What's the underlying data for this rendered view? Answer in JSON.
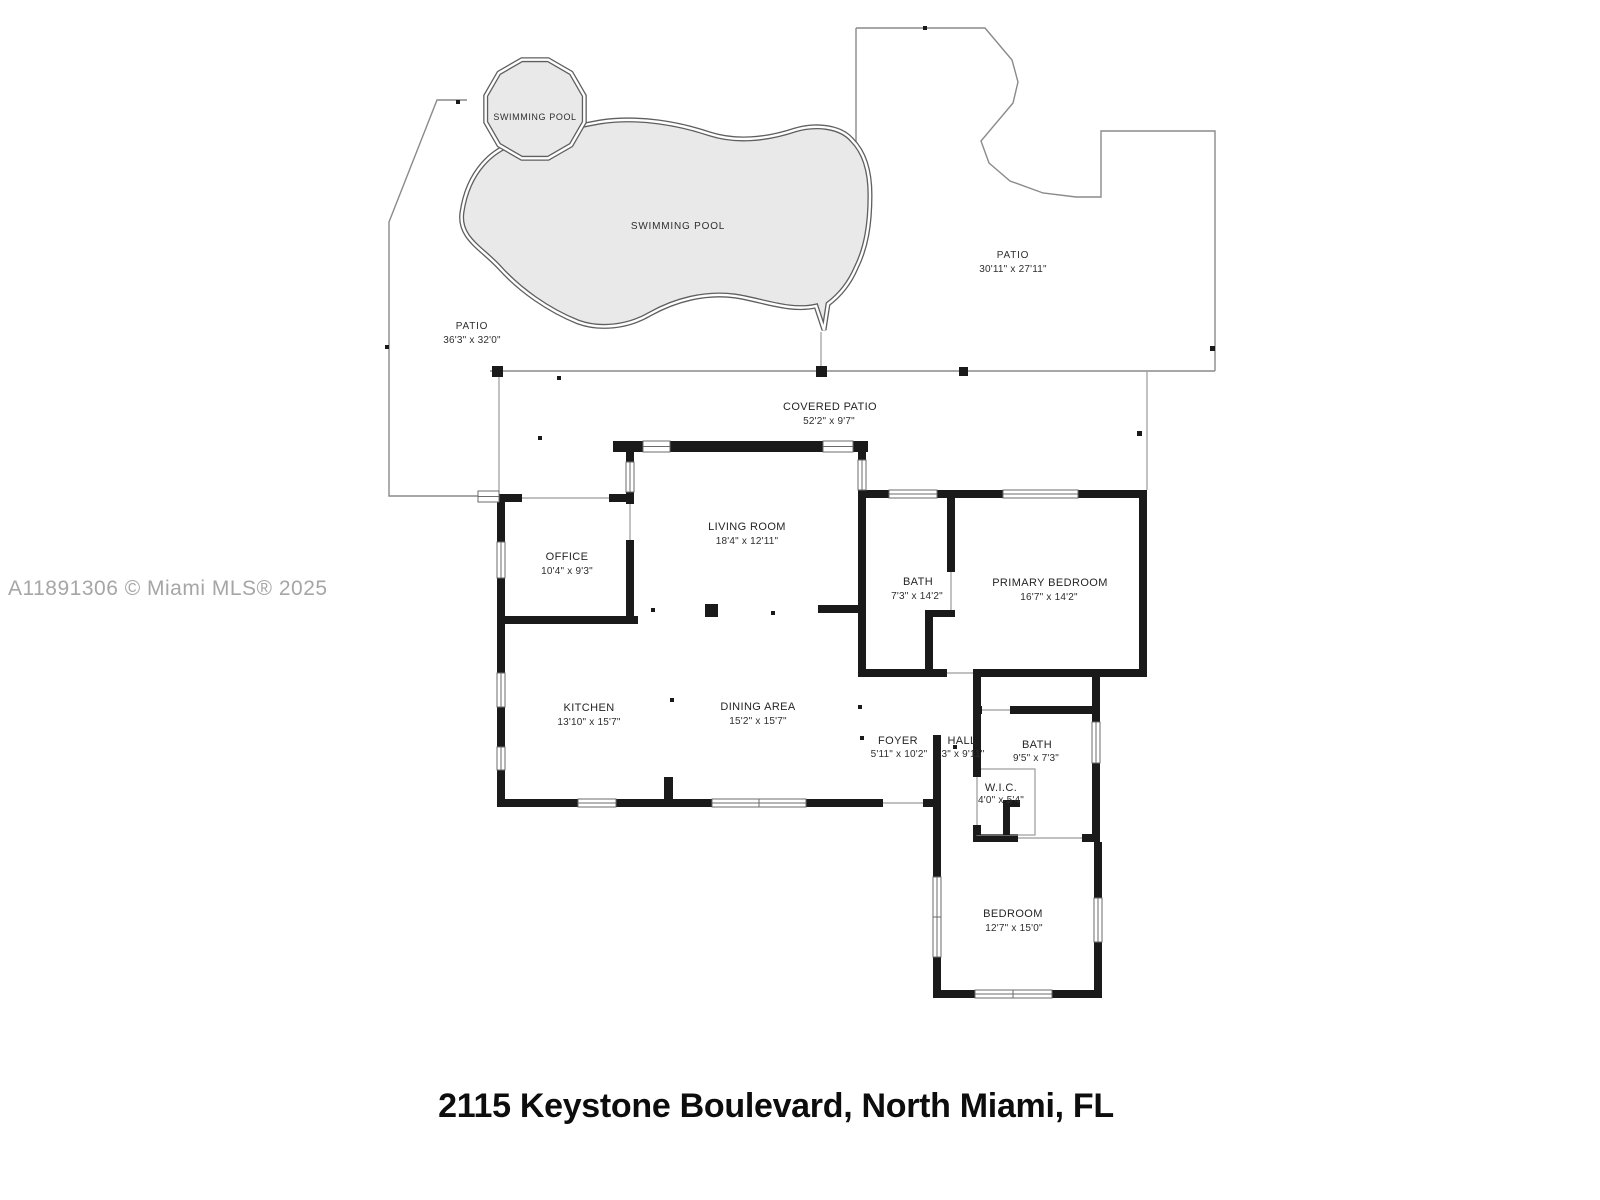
{
  "document": {
    "watermark": "A11891306 © Miami MLS® 2025",
    "address_title": "2115 Keystone Boulevard, North Miami, FL"
  },
  "colors": {
    "wall": "#1a1a1a",
    "thin_line": "#8a8a8a",
    "pool_fill": "#e9e9e9",
    "pool_outline": "#5f5f5f",
    "watermark_gray": "#a6a6a6",
    "background": "#ffffff"
  },
  "outdoor": {
    "small_pool": {
      "label": "SWIMMING POOL"
    },
    "large_pool": {
      "label": "SWIMMING POOL"
    },
    "patio_left": {
      "name": "PATIO",
      "dims": "36'3\" x 32'0\""
    },
    "patio_right": {
      "name": "PATIO",
      "dims": "30'11\" x 27'11\""
    },
    "covered_patio": {
      "name": "COVERED PATIO",
      "dims": "52'2\" x 9'7\""
    }
  },
  "rooms": {
    "living_room": {
      "name": "LIVING ROOM",
      "dims": "18'4\" x 12'11\""
    },
    "office": {
      "name": "OFFICE",
      "dims": "10'4\" x 9'3\""
    },
    "bath_primary": {
      "name": "BATH",
      "dims": "7'3\" x 14'2\""
    },
    "primary_bedroom": {
      "name": "PRIMARY BEDROOM",
      "dims": "16'7\" x 14'2\""
    },
    "kitchen": {
      "name": "KITCHEN",
      "dims": "13'10\" x 15'7\""
    },
    "dining_area": {
      "name": "DINING AREA",
      "dims": "15'2\" x 15'7\""
    },
    "foyer": {
      "name": "FOYER",
      "dims": "5'11\" x 10'2\""
    },
    "hall": {
      "name": "HALL",
      "dims": "3\" x 9'11\""
    },
    "bath_hall": {
      "name": "BATH",
      "dims": "9'5\" x 7'3\""
    },
    "wic": {
      "name": "W.I.C.",
      "dims": "4'0\" x 5'4\""
    },
    "bedroom": {
      "name": "BEDROOM",
      "dims": "12'7\" x 15'0\""
    }
  }
}
